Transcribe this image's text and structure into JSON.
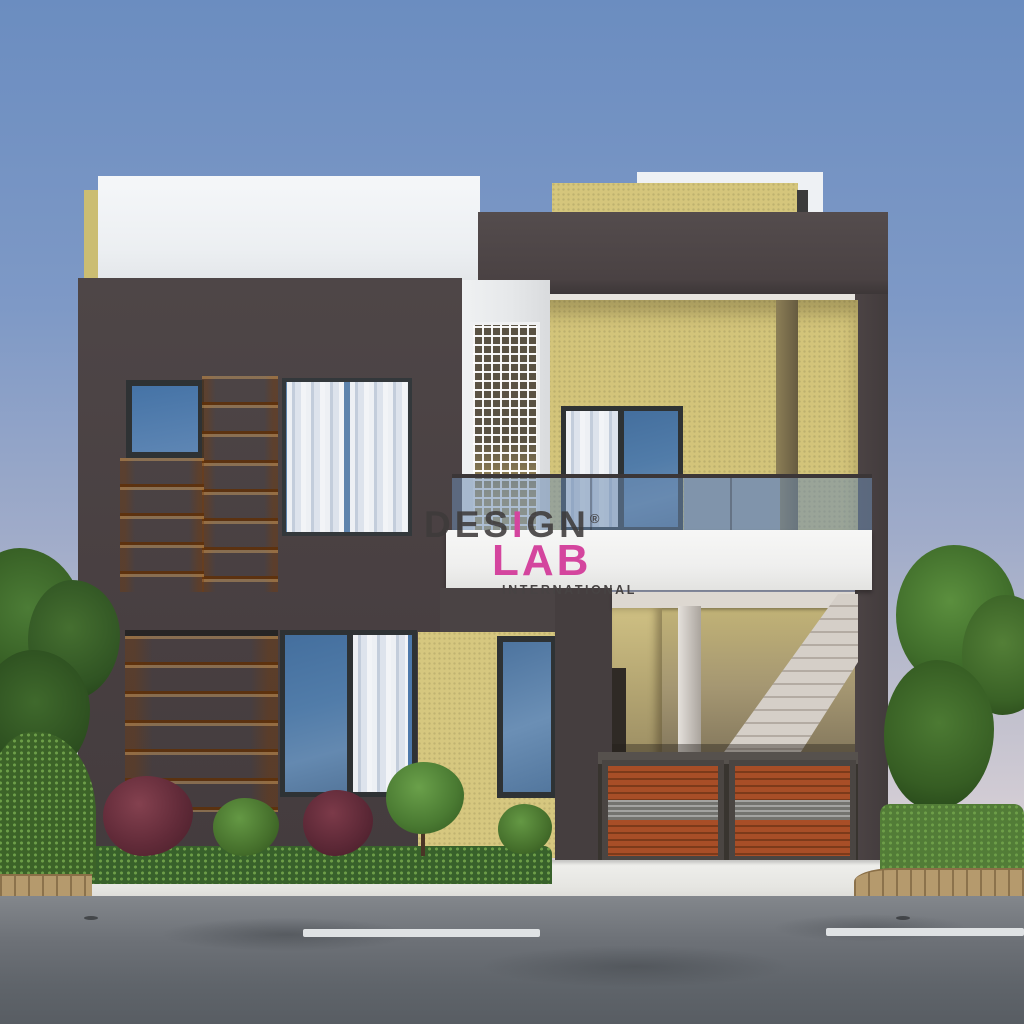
{
  "scene": {
    "description": "3D architectural render of a modern two-storey duplex house front elevation with wood accents, glass balcony railing, jali lattice panel, staircase porch, slatted gates, hedges and asphalt road",
    "time_of_day": "dusk"
  },
  "watermark": {
    "brand_pre": "DES",
    "brand_accent_letter": "I",
    "brand_post": "GN",
    "registered_mark": "®",
    "brand_secondary": "LAB",
    "tagline": "INTERNATIONAL",
    "accent_color": "#d4459e",
    "primary_text_color": "#484444"
  },
  "palette": {
    "sky_top": "#6b8dc0",
    "sky_horizon": "#d9d1d7",
    "facade_dark_gray": "#4a4344",
    "stucco_beige": "#d5c67c",
    "wood_orange": "#c96f1c",
    "slab_white": "#f4f4f3",
    "window_glass_blue": "#517ca9",
    "railing_glass": "rgba(108,138,176,0.55)",
    "gate_wood_rust": "#a84e27",
    "hedge_green": "#38612b",
    "road_gray": "#6b7077",
    "lane_marking_white": "#dfe2e4",
    "paver_tan": "#b59a6d"
  }
}
